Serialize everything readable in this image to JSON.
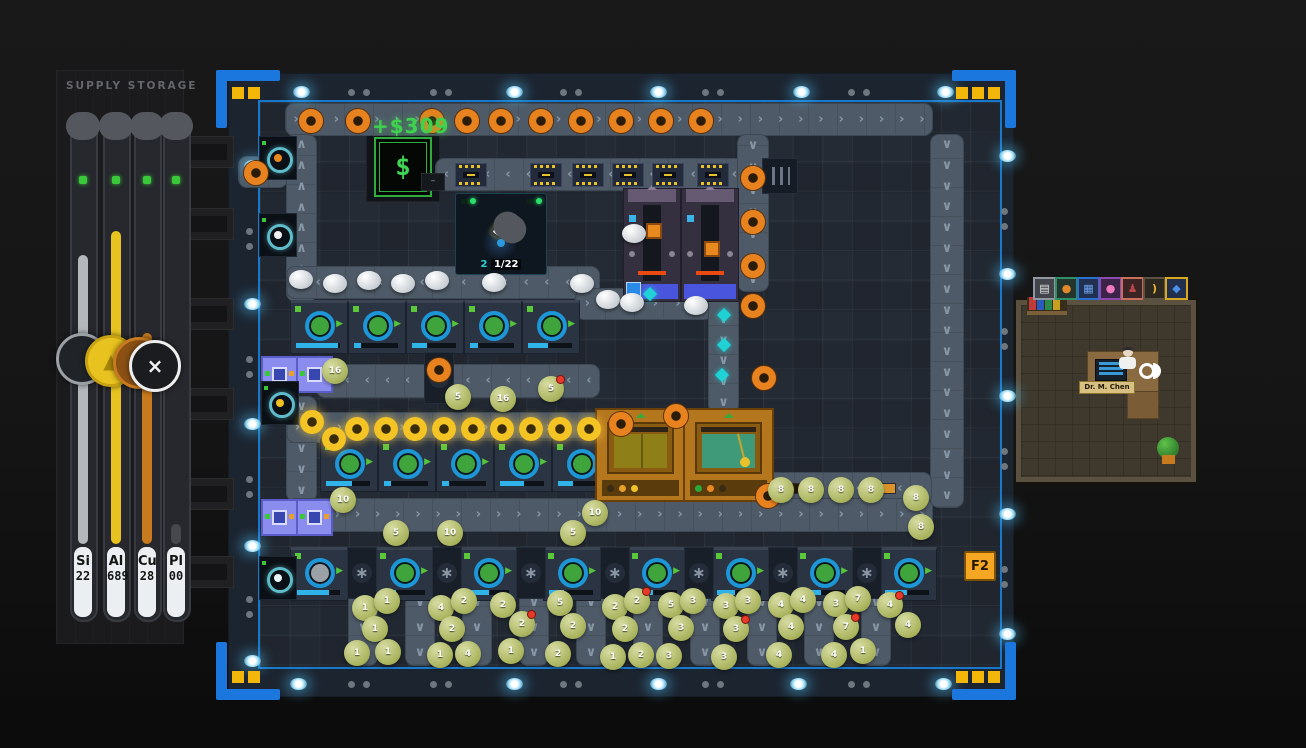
{
  "supply_storage": {
    "title": "SUPPLY STORAGE",
    "tubes": [
      {
        "label": "Si",
        "value": "22",
        "color": "#b4b8bc",
        "pct": 85
      },
      {
        "label": "Al",
        "value": "689",
        "color": "#e8c21e",
        "pct": 92
      },
      {
        "label": "Cu",
        "value": "28",
        "color": "#c87a1e",
        "pct": 62
      },
      {
        "label": "Pl",
        "value": "00",
        "color": "#46484c",
        "pct": 6
      }
    ],
    "badges": [
      {
        "name": "resource-badge-silicon",
        "ring": "#9aa0a6",
        "bg": "#202428",
        "glyph": "",
        "color": "#6a7076",
        "x": 56,
        "y": 333
      },
      {
        "name": "resource-badge-sulfur",
        "ring": "#c8a212",
        "bg": "#e8c21e",
        "glyph": "▲",
        "color": "#a8860a",
        "x": 85,
        "y": 335
      },
      {
        "name": "resource-badge-copper",
        "ring": "#c87a1e",
        "bg": "#8a5014",
        "glyph": "≡",
        "color": "#e8a04a",
        "x": 113,
        "y": 337
      },
      {
        "name": "resource-badge-plastic",
        "ring": "#eeeeee",
        "bg": "#1a1c20",
        "glyph": "×",
        "color": "#f2f2f2",
        "x": 129,
        "y": 340
      }
    ]
  },
  "economy": {
    "floating_gain": "+$309",
    "money_symbol": "$",
    "display_dash": "–"
  },
  "lab_info": {
    "count": "2",
    "progress": "1/22"
  },
  "shortcut_badge": {
    "label": "F2"
  },
  "office": {
    "person_label": "Dr. M. Chen",
    "book_colors": [
      "#c03a3a",
      "#2a5ac0",
      "#2a8a4a",
      "#c8a020"
    ],
    "icons": [
      {
        "name": "document-icon",
        "border": "#9097a0",
        "bg": "#42464c",
        "glyph": "▤",
        "color": "#e6e6e6"
      },
      {
        "name": "lamp-icon",
        "border": "#2f9068",
        "bg": "#23352c",
        "glyph": "●",
        "color": "#e0882a"
      },
      {
        "name": "crystal-icon",
        "border": "#2a6fd4",
        "bg": "#20304e",
        "glyph": "▦",
        "color": "#6aa2ee"
      },
      {
        "name": "brain-icon",
        "border": "#8a4ab0",
        "bg": "#3c2348",
        "glyph": "●",
        "color": "#f07ac0"
      },
      {
        "name": "figure-icon",
        "border": "#c8705a",
        "bg": "#3c2424",
        "glyph": "♟",
        "color": "#b84848"
      },
      {
        "name": "hook-icon",
        "border": "#5a5244",
        "bg": "#2c2820",
        "glyph": ")",
        "color": "#e8b830"
      },
      {
        "name": "gem-icon",
        "border": "#d8a820",
        "bg": "#22304e",
        "glyph": "◆",
        "color": "#4a90e8"
      }
    ]
  },
  "scene": {
    "belts": [
      {
        "x": 238,
        "y": 156,
        "w": 48,
        "h": 30,
        "dir": "right"
      },
      {
        "x": 285,
        "y": 103,
        "w": 646,
        "h": 31,
        "dir": "right"
      },
      {
        "x": 930,
        "y": 134,
        "w": 32,
        "h": 372,
        "dir": "down"
      },
      {
        "x": 764,
        "y": 472,
        "w": 166,
        "h": 31,
        "dir": "left"
      },
      {
        "x": 286,
        "y": 134,
        "w": 29,
        "h": 166,
        "dir": "up"
      },
      {
        "x": 286,
        "y": 396,
        "w": 29,
        "h": 104,
        "dir": "down"
      },
      {
        "x": 435,
        "y": 158,
        "w": 350,
        "h": 31,
        "dir": "left"
      },
      {
        "x": 286,
        "y": 266,
        "w": 312,
        "h": 31,
        "dir": "left"
      },
      {
        "x": 575,
        "y": 288,
        "w": 136,
        "h": 30,
        "dir": "right"
      },
      {
        "x": 708,
        "y": 288,
        "w": 29,
        "h": 124,
        "dir": "down"
      },
      {
        "x": 737,
        "y": 134,
        "w": 30,
        "h": 156,
        "dir": "down"
      },
      {
        "x": 316,
        "y": 364,
        "w": 282,
        "h": 32,
        "dir": "left"
      },
      {
        "x": 286,
        "y": 412,
        "w": 314,
        "h": 29,
        "dir": "right"
      },
      {
        "x": 286,
        "y": 498,
        "w": 645,
        "h": 32,
        "dir": "right"
      },
      {
        "x": 348,
        "y": 590,
        "w": 28,
        "h": 74,
        "dir": "down"
      },
      {
        "x": 405,
        "y": 590,
        "w": 28,
        "h": 74,
        "dir": "down"
      },
      {
        "x": 462,
        "y": 590,
        "w": 28,
        "h": 74,
        "dir": "down"
      },
      {
        "x": 519,
        "y": 590,
        "w": 28,
        "h": 74,
        "dir": "down"
      },
      {
        "x": 576,
        "y": 590,
        "w": 28,
        "h": 74,
        "dir": "down"
      },
      {
        "x": 633,
        "y": 590,
        "w": 28,
        "h": 74,
        "dir": "down"
      },
      {
        "x": 690,
        "y": 590,
        "w": 28,
        "h": 74,
        "dir": "down"
      },
      {
        "x": 747,
        "y": 590,
        "w": 28,
        "h": 74,
        "dir": "down"
      },
      {
        "x": 804,
        "y": 590,
        "w": 28,
        "h": 74,
        "dir": "down"
      },
      {
        "x": 861,
        "y": 590,
        "w": 28,
        "h": 74,
        "dir": "down"
      }
    ],
    "extractors": [
      {
        "x": 290,
        "y": 300,
        "p": 95
      },
      {
        "x": 348,
        "y": 300,
        "p": 15
      },
      {
        "x": 406,
        "y": 300,
        "p": 35
      },
      {
        "x": 464,
        "y": 300,
        "p": 18
      },
      {
        "x": 522,
        "y": 300,
        "p": 45
      },
      {
        "x": 320,
        "y": 438,
        "p": 60
      },
      {
        "x": 378,
        "y": 438,
        "p": 15
      },
      {
        "x": 436,
        "y": 438,
        "p": 15
      },
      {
        "x": 494,
        "y": 438,
        "p": 55
      },
      {
        "x": 552,
        "y": 438,
        "p": 35
      },
      {
        "x": 290,
        "y": 547,
        "p": 75,
        "gray": true
      },
      {
        "x": 375,
        "y": 547,
        "p": 35
      },
      {
        "x": 459,
        "y": 547,
        "p": 55
      },
      {
        "x": 543,
        "y": 547,
        "p": 35
      },
      {
        "x": 627,
        "y": 547,
        "p": 45
      },
      {
        "x": 711,
        "y": 547,
        "p": 40
      },
      {
        "x": 795,
        "y": 547,
        "p": 45
      },
      {
        "x": 879,
        "y": 547,
        "p": 50
      }
    ],
    "gearblocks": [
      {
        "x": 347,
        "y": 547
      },
      {
        "x": 432,
        "y": 547
      },
      {
        "x": 516,
        "y": 547
      },
      {
        "x": 600,
        "y": 547
      },
      {
        "x": 684,
        "y": 547
      },
      {
        "x": 768,
        "y": 547
      },
      {
        "x": 852,
        "y": 547
      },
      {
        "x": 610,
        "y": 438
      },
      {
        "x": 424,
        "y": 352
      }
    ],
    "vents": [
      {
        "x": 762,
        "y": 158
      }
    ],
    "purple_machines": [
      {
        "x": 623,
        "y": 188
      },
      {
        "x": 681,
        "y": 188
      }
    ],
    "orange_machines": [
      {
        "x": 595,
        "y": 408,
        "screen": "olive"
      },
      {
        "x": 683,
        "y": 408,
        "screen": "teal"
      }
    ],
    "filters": [
      {
        "x": 261,
        "y": 356
      },
      {
        "x": 296,
        "y": 356
      },
      {
        "x": 261,
        "y": 499
      },
      {
        "x": 296,
        "y": 499
      }
    ],
    "emitters": [
      {
        "x": 259,
        "y": 136,
        "dot": "#e8891f"
      },
      {
        "x": 259,
        "y": 213,
        "dot": "#f0f0f0"
      },
      {
        "x": 261,
        "y": 381,
        "dot": "#f0c020"
      },
      {
        "x": 259,
        "y": 556,
        "dot": "#e8f8f8"
      }
    ],
    "gears_orange": [
      [
        299,
        109
      ],
      [
        346,
        109
      ],
      [
        420,
        109
      ],
      [
        455,
        109
      ],
      [
        489,
        109
      ],
      [
        529,
        109
      ],
      [
        569,
        109
      ],
      [
        609,
        109
      ],
      [
        649,
        109
      ],
      [
        689,
        109
      ],
      [
        244,
        161
      ],
      [
        741,
        166
      ],
      [
        741,
        210
      ],
      [
        741,
        254
      ],
      [
        741,
        294
      ],
      [
        609,
        412
      ],
      [
        664,
        404
      ],
      [
        752,
        366
      ],
      [
        427,
        358
      ],
      [
        756,
        484
      ]
    ],
    "gears_yellow": [
      [
        300,
        410
      ],
      [
        322,
        427
      ],
      [
        345,
        417
      ],
      [
        374,
        417
      ],
      [
        403,
        417
      ],
      [
        432,
        417
      ],
      [
        461,
        417
      ],
      [
        490,
        417
      ],
      [
        519,
        417
      ],
      [
        548,
        417
      ],
      [
        577,
        417
      ]
    ],
    "diamonds": [
      [
        645,
        289
      ],
      [
        719,
        310
      ],
      [
        719,
        340
      ],
      [
        717,
        370
      ]
    ],
    "chips": [
      [
        455,
        163
      ],
      [
        530,
        163
      ],
      [
        572,
        163
      ],
      [
        612,
        163
      ],
      [
        652,
        163
      ],
      [
        697,
        163
      ]
    ],
    "white_blobs": [
      [
        289,
        270
      ],
      [
        323,
        274
      ],
      [
        357,
        271
      ],
      [
        391,
        274
      ],
      [
        425,
        271
      ],
      [
        482,
        273
      ],
      [
        570,
        274
      ],
      [
        596,
        290
      ],
      [
        620,
        293
      ],
      [
        684,
        296
      ],
      [
        622,
        224
      ]
    ],
    "blobs": [
      [
        322,
        358,
        "16",
        0
      ],
      [
        445,
        384,
        "5",
        0
      ],
      [
        490,
        386,
        "16",
        0
      ],
      [
        538,
        376,
        "5",
        1
      ],
      [
        330,
        487,
        "10",
        0
      ],
      [
        383,
        520,
        "5",
        0
      ],
      [
        437,
        520,
        "10",
        0
      ],
      [
        560,
        520,
        "5",
        0
      ],
      [
        582,
        500,
        "10",
        0
      ],
      [
        768,
        477,
        "8",
        0
      ],
      [
        798,
        477,
        "8",
        0
      ],
      [
        828,
        477,
        "8",
        0
      ],
      [
        858,
        477,
        "8",
        0
      ],
      [
        903,
        485,
        "8",
        0
      ],
      [
        908,
        514,
        "8",
        0
      ],
      [
        352,
        595,
        "1",
        0
      ],
      [
        374,
        588,
        "1",
        0
      ],
      [
        362,
        616,
        "1",
        0
      ],
      [
        344,
        640,
        "1",
        0
      ],
      [
        375,
        639,
        "1",
        0
      ],
      [
        428,
        595,
        "4",
        0
      ],
      [
        451,
        588,
        "2",
        0
      ],
      [
        439,
        616,
        "2",
        0
      ],
      [
        427,
        642,
        "1",
        0
      ],
      [
        455,
        641,
        "4",
        0
      ],
      [
        490,
        592,
        "2",
        0
      ],
      [
        509,
        611,
        "2",
        1
      ],
      [
        498,
        638,
        "1",
        0
      ],
      [
        547,
        590,
        "5",
        0
      ],
      [
        560,
        613,
        "2",
        0
      ],
      [
        545,
        641,
        "2",
        0
      ],
      [
        602,
        594,
        "2",
        0
      ],
      [
        624,
        588,
        "2",
        1
      ],
      [
        612,
        616,
        "2",
        0
      ],
      [
        600,
        644,
        "1",
        0
      ],
      [
        628,
        642,
        "2",
        0
      ],
      [
        658,
        592,
        "5",
        0
      ],
      [
        680,
        588,
        "3",
        0
      ],
      [
        668,
        615,
        "3",
        0
      ],
      [
        656,
        643,
        "3",
        0
      ],
      [
        713,
        593,
        "3",
        0
      ],
      [
        735,
        588,
        "3",
        0
      ],
      [
        723,
        616,
        "3",
        1
      ],
      [
        711,
        644,
        "3",
        0
      ],
      [
        768,
        592,
        "4",
        0
      ],
      [
        790,
        587,
        "4",
        0
      ],
      [
        778,
        614,
        "4",
        0
      ],
      [
        766,
        642,
        "4",
        0
      ],
      [
        823,
        591,
        "3",
        0
      ],
      [
        845,
        586,
        "7",
        0
      ],
      [
        833,
        614,
        "7",
        1
      ],
      [
        821,
        642,
        "4",
        0
      ],
      [
        850,
        638,
        "1",
        0
      ],
      [
        877,
        592,
        "4",
        1
      ],
      [
        895,
        612,
        "4",
        0
      ]
    ],
    "lights_big": [
      [
        293,
        86
      ],
      [
        506,
        86
      ],
      [
        650,
        86
      ],
      [
        793,
        86
      ],
      [
        937,
        86
      ],
      [
        290,
        678
      ],
      [
        506,
        678
      ],
      [
        650,
        678
      ],
      [
        790,
        678
      ],
      [
        935,
        678
      ],
      [
        244,
        160
      ],
      [
        244,
        298
      ],
      [
        244,
        418
      ],
      [
        244,
        540
      ],
      [
        244,
        655
      ],
      [
        999,
        150
      ],
      [
        999,
        268
      ],
      [
        999,
        390
      ],
      [
        999,
        508
      ],
      [
        999,
        628
      ]
    ],
    "lights_small": [
      [
        348,
        89
      ],
      [
        363,
        89
      ],
      [
        430,
        89
      ],
      [
        445,
        89
      ],
      [
        560,
        89
      ],
      [
        575,
        89
      ],
      [
        702,
        89
      ],
      [
        717,
        89
      ],
      [
        848,
        89
      ],
      [
        863,
        89
      ],
      [
        348,
        681
      ],
      [
        363,
        681
      ],
      [
        430,
        681
      ],
      [
        445,
        681
      ],
      [
        560,
        681
      ],
      [
        575,
        681
      ],
      [
        702,
        681
      ],
      [
        717,
        681
      ],
      [
        848,
        681
      ],
      [
        863,
        681
      ],
      [
        246,
        228
      ],
      [
        246,
        243
      ],
      [
        246,
        356
      ],
      [
        246,
        371
      ],
      [
        246,
        476
      ],
      [
        246,
        491
      ],
      [
        246,
        596
      ],
      [
        246,
        611
      ],
      [
        1001,
        208
      ],
      [
        1001,
        223
      ],
      [
        1001,
        328
      ],
      [
        1001,
        343
      ],
      [
        1001,
        448
      ],
      [
        1001,
        463
      ],
      [
        1001,
        566
      ],
      [
        1001,
        581
      ]
    ],
    "corners": [
      {
        "x": 216,
        "y": 70,
        "o": "tl",
        "sq": 2
      },
      {
        "x": 952,
        "y": 70,
        "o": "tr",
        "sq": 3
      },
      {
        "x": 216,
        "y": 642,
        "o": "bl",
        "sq": 2
      },
      {
        "x": 952,
        "y": 642,
        "o": "br",
        "sq": 3
      }
    ],
    "slots": [
      136,
      208,
      298,
      388,
      478,
      556
    ]
  }
}
